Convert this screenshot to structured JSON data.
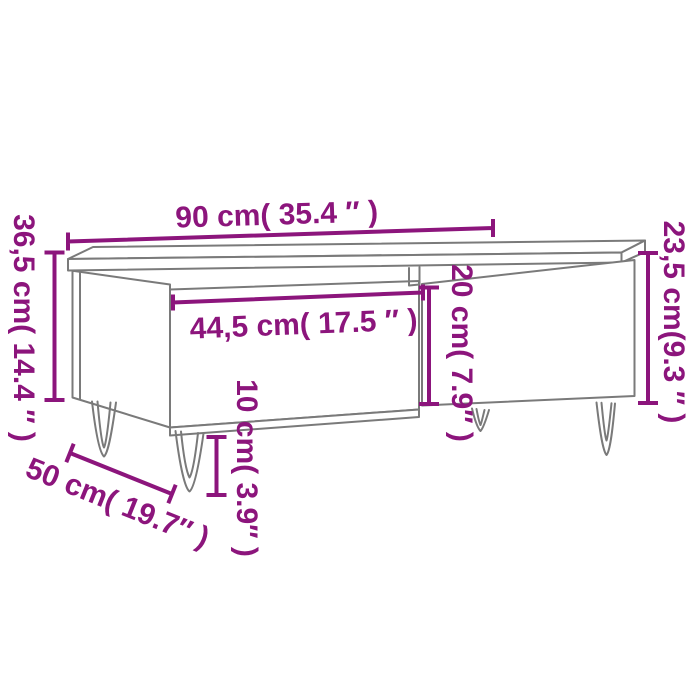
{
  "page": {
    "background_color": "#ffffff"
  },
  "diagram": {
    "title": "Coffee table dimension diagram",
    "product": "coffee table with drawer and hairpin legs, isometric line drawing",
    "accent_color": "#8c157c",
    "line_color": "#7a7a7a",
    "dimensions": {
      "top_width": {
        "label": "90 cm( 35.4 ″ )",
        "cm": "90",
        "inches": "35.4"
      },
      "total_height": {
        "label": "36,5 cm( 14.4 ″ )",
        "cm": "36,5",
        "inches": "14.4"
      },
      "body_height": {
        "label": "23,5 cm(9.3 ″ )",
        "cm": "23,5",
        "inches": "9.3"
      },
      "drawer_width": {
        "label": "44,5 cm( 17.5 ″ )",
        "cm": "44,5",
        "inches": "17.5"
      },
      "front_panel_height": {
        "label": "20 cm( 7.9″ )",
        "cm": "20",
        "inches": "7.9"
      },
      "leg_height": {
        "label": "10 cm( 3.9″ )",
        "cm": "10",
        "inches": "3.9"
      },
      "depth": {
        "label": "50 cm( 19.7″ )",
        "cm": "50",
        "inches": "19.7"
      }
    }
  }
}
